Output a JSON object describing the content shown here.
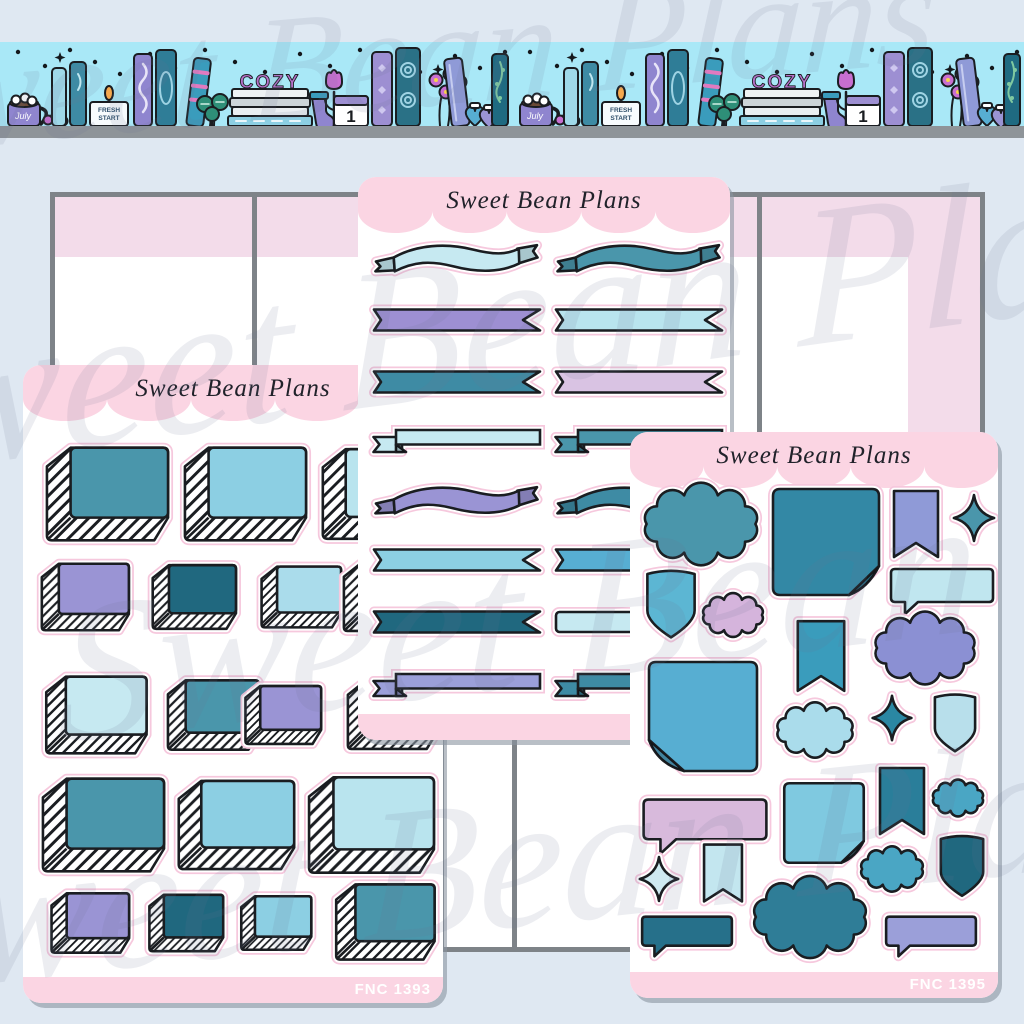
{
  "brand": "Sweet Bean Plans",
  "watermark": {
    "text": "Sweet Bean Plans"
  },
  "banner": {
    "cozy": "COZY",
    "candle_line1": "FRESH",
    "candle_line2": "START",
    "calendar_day": "1",
    "mug_text": "July"
  },
  "sheets": {
    "left": {
      "title": "Sweet Bean Plans",
      "sku": "FNC 1393"
    },
    "middle": {
      "title": "Sweet Bean Plans"
    },
    "right": {
      "title": "Sweet Bean Plans",
      "sku": "FNC 1395"
    }
  },
  "palette": {
    "background": "#dfe8f2",
    "banner_cyan": "#a9e8f7",
    "shelf_gray": "#8e9499",
    "panel_border": "#7e8388",
    "panel_pink": "#f3dcea",
    "sheet_pink": "#fbd5e3",
    "halo_pink": "#f6c8dd",
    "outline": "#1a1d21",
    "teal": "#4a96ab",
    "teal_med": "#3e8ba4",
    "teal_deep": "#2f7d97",
    "teal_dark": "#20687f",
    "teal_ink": "#26708a",
    "sticky_teal": "#3388a5",
    "blue": "#57aed2",
    "sky": "#5cb6d3",
    "blue_med": "#4aa6c4",
    "flag_teal": "#3a9cbc",
    "flag_teal2": "#2a7e9a",
    "sticky_blue": "#7fc9e0",
    "light_blue": "#8ccfe3",
    "pale_blue": "#b9e4ee",
    "pale_cyan": "#c6e9f1",
    "cloud_pale": "#aadceb",
    "shield_pale": "#b8dfeb",
    "speech_pale": "#c0e6ef",
    "flag_pale": "#c3e6ef",
    "ice": "#cfe9f1",
    "periwinkle": "#9a94d4",
    "periwinkle2": "#9b9fd9",
    "peri_flag": "#8f9ad7",
    "peri_cloud": "#8b90d3",
    "purple": "#9d8fd2",
    "lavender": "#d9c3e3",
    "pink_lavender": "#d5b4dc",
    "pink_speech": "#d8badc",
    "sparkle_deep": "#2a87a3",
    "cozy_purple": "#b671c9",
    "watermark_gray": "#6a7590"
  }
}
